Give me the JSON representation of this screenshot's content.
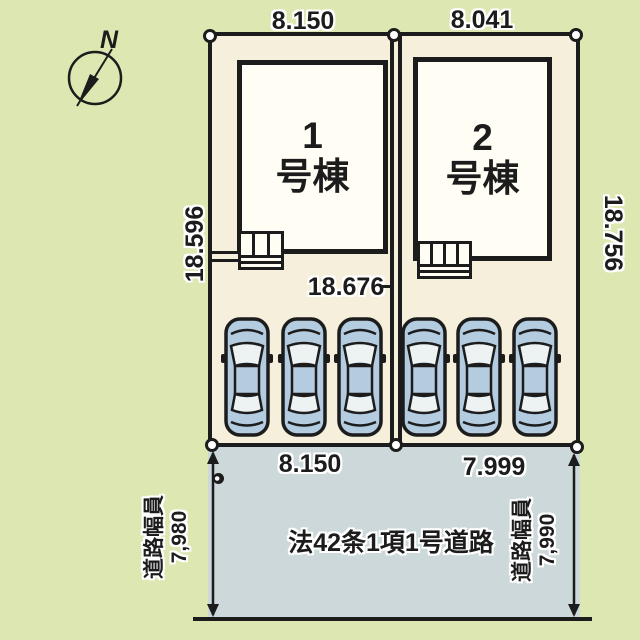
{
  "site_plan": {
    "compass": {
      "north_label": "N"
    },
    "buildings": [
      {
        "number": "1",
        "suffix": "号棟"
      },
      {
        "number": "2",
        "suffix": "号棟"
      }
    ],
    "lot_dimensions": {
      "lot1_top_width": "8.150",
      "lot2_top_width": "8.041",
      "left_depth": "18.596",
      "right_depth": "18.756",
      "middle_depth": "18.676",
      "lot1_bottom_width": "8.150",
      "lot2_bottom_width": "7.999"
    },
    "road": {
      "name": "法42条1項1号道路",
      "left_width_label": "道路幅員",
      "left_width_value": "7,980",
      "right_width_label": "道路幅員",
      "right_width_value": "7,990"
    },
    "parking": {
      "car_count": 6
    },
    "colors": {
      "background": "#dde7b1",
      "lot_fill": "#f6efdc",
      "building_fill": "#fffdf4",
      "road_fill": "#ccd8da",
      "line": "#1c1c1c",
      "car_body": "#b4cce0"
    }
  }
}
